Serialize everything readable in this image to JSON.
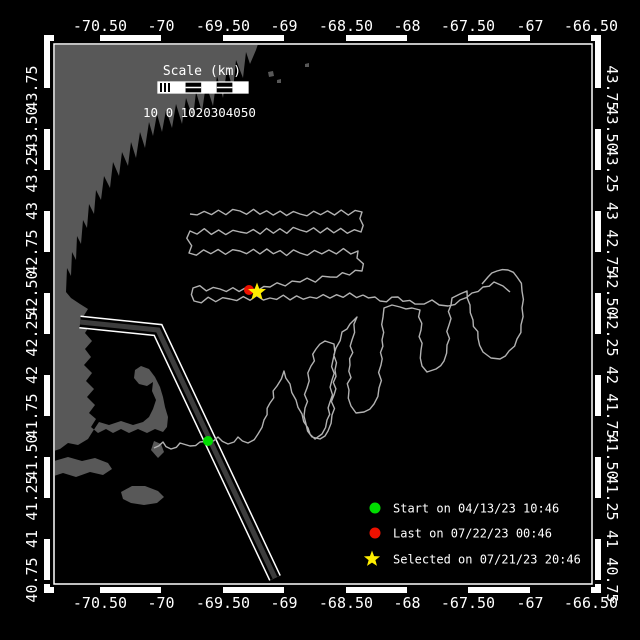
{
  "figure": {
    "kind": "vehicle-track-map",
    "background": "#000000",
    "frame_color": "#ffffff"
  },
  "axes": {
    "lon_labels": [
      "-70.50",
      "-70",
      "-69.50",
      "-69",
      "-68.50",
      "-68",
      "-67.50",
      "-67",
      "-66.50"
    ],
    "lat_labels": [
      "43.75",
      "43.50",
      "43.25",
      "43",
      "42.75",
      "42.50",
      "42.25",
      "42",
      "41.75",
      "41.50",
      "41.25",
      "41",
      "40.75"
    ],
    "lon_range": [
      -70.81,
      -66.5
    ],
    "lat_range": [
      40.72,
      43.97
    ]
  },
  "scalebar": {
    "title": "Scale (km)",
    "labels": "10 0 1020304050"
  },
  "legend": {
    "items": [
      {
        "marker": "circle",
        "color": "#00dd00",
        "label": "Start on 04/13/23 10:46"
      },
      {
        "marker": "circle",
        "color": "#ee1100",
        "label": "Last on 07/22/23 00:46"
      },
      {
        "marker": "star",
        "color": "#ffee00",
        "label": "Selected on 07/21/23 20:46"
      }
    ]
  },
  "map": {
    "land_color": "#585858",
    "track_color": "#b2b2b2",
    "lane_fill": "#3c3c3c",
    "lane_edge": "#ffffff",
    "markers": [
      {
        "name": "start-marker",
        "type": "circle",
        "color": "#00dd00",
        "x": 208,
        "y": 441,
        "r": 5
      },
      {
        "name": "last-marker",
        "type": "circle",
        "color": "#ee1100",
        "x": 249,
        "y": 290,
        "r": 5
      },
      {
        "name": "selected-marker",
        "type": "star",
        "color": "#ffee00",
        "x": 257,
        "y": 292,
        "r": 9.5
      }
    ],
    "lane": [
      [
        80,
        322
      ],
      [
        158,
        330
      ],
      [
        275,
        578
      ]
    ],
    "tracks": [
      {
        "name": "survey-lawnmower",
        "amp": 2.4,
        "pts": [
          [
            190,
            214
          ],
          [
            240,
            211
          ],
          [
            300,
            214
          ],
          [
            362,
            212
          ],
          [
            361,
            232
          ],
          [
            300,
            230
          ],
          [
            240,
            232
          ],
          [
            190,
            231
          ],
          [
            189,
            253
          ],
          [
            240,
            251
          ],
          [
            300,
            253
          ],
          [
            358,
            251
          ],
          [
            362,
            271
          ],
          [
            330,
            277
          ],
          [
            300,
            282
          ],
          [
            270,
            287
          ],
          [
            252,
            290
          ],
          [
            220,
            289
          ],
          [
            193,
            288
          ],
          [
            194,
            301
          ],
          [
            230,
            299
          ],
          [
            270,
            298
          ],
          [
            310,
            297
          ],
          [
            363,
            295
          ]
        ]
      },
      {
        "name": "transit-east",
        "amp": 1.8,
        "pts": [
          [
            363,
            295
          ],
          [
            380,
            301
          ],
          [
            398,
            297
          ],
          [
            415,
            304
          ],
          [
            432,
            300
          ],
          [
            448,
            306
          ],
          [
            460,
            300
          ],
          [
            472,
            293
          ],
          [
            483,
            287
          ],
          [
            494,
            282
          ],
          [
            503,
            286
          ],
          [
            510,
            292
          ]
        ]
      },
      {
        "name": "trail-and-comb",
        "amp": 1.6,
        "pts": [
          [
            154,
            448
          ],
          [
            163,
            442
          ],
          [
            171,
            449
          ],
          [
            180,
            443
          ],
          [
            190,
            446
          ],
          [
            200,
            442
          ],
          [
            208,
            441
          ],
          [
            218,
            437
          ],
          [
            228,
            444
          ],
          [
            238,
            437
          ],
          [
            248,
            443
          ],
          [
            258,
            434
          ],
          [
            264,
            420
          ],
          [
            270,
            403
          ],
          [
            277,
            386
          ],
          [
            284,
            371
          ],
          [
            290,
            384
          ],
          [
            296,
            400
          ],
          [
            302,
            414
          ],
          [
            308,
            428
          ],
          [
            315,
            439
          ],
          [
            322,
            434
          ],
          [
            327,
            420
          ],
          [
            330,
            402
          ],
          [
            332,
            380
          ],
          [
            333,
            360
          ],
          [
            334,
            344
          ],
          [
            325,
            341
          ],
          [
            316,
            349
          ],
          [
            311,
            366
          ],
          [
            307,
            388
          ],
          [
            305,
            408
          ],
          [
            306,
            424
          ],
          [
            312,
            437
          ],
          [
            320,
            439
          ],
          [
            328,
            431
          ],
          [
            332,
            415
          ],
          [
            334,
            395
          ],
          [
            335,
            370
          ],
          [
            336,
            348
          ],
          [
            342,
            332
          ],
          [
            350,
            324
          ],
          [
            357,
            317
          ],
          [
            352,
            340
          ],
          [
            350,
            365
          ],
          [
            349,
            390
          ],
          [
            351,
            406
          ],
          [
            356,
            413
          ],
          [
            364,
            412
          ],
          [
            374,
            404
          ],
          [
            379,
            388
          ],
          [
            381,
            365
          ],
          [
            382,
            340
          ],
          [
            383,
            317
          ],
          [
            384,
            308
          ],
          [
            392,
            305
          ],
          [
            400,
            307
          ],
          [
            412,
            308
          ],
          [
            420,
            310
          ],
          [
            421,
            330
          ],
          [
            421,
            350
          ],
          [
            422,
            366
          ],
          [
            427,
            372
          ],
          [
            436,
            369
          ],
          [
            444,
            361
          ],
          [
            447,
            345
          ],
          [
            449,
            325
          ],
          [
            451,
            305
          ],
          [
            452,
            298
          ],
          [
            460,
            294
          ],
          [
            467,
            291
          ],
          [
            470,
            305
          ],
          [
            473,
            320
          ],
          [
            478,
            338
          ],
          [
            483,
            352
          ],
          [
            491,
            358
          ],
          [
            500,
            359
          ],
          [
            509,
            351
          ],
          [
            517,
            339
          ],
          [
            521,
            325
          ],
          [
            522,
            308
          ],
          [
            522,
            291
          ],
          [
            517,
            277
          ],
          [
            508,
            270
          ],
          [
            497,
            271
          ],
          [
            488,
            277
          ],
          [
            482,
            284
          ]
        ]
      }
    ],
    "land": [
      [
        [
          54,
          44
        ],
        [
          258,
          44
        ],
        [
          256,
          50
        ],
        [
          250,
          64
        ],
        [
          246,
          52
        ],
        [
          243,
          78
        ],
        [
          236,
          60
        ],
        [
          233,
          90
        ],
        [
          227,
          68
        ],
        [
          223,
          98
        ],
        [
          217,
          76
        ],
        [
          213,
          106
        ],
        [
          206,
          84
        ],
        [
          202,
          112
        ],
        [
          196,
          92
        ],
        [
          193,
          118
        ],
        [
          186,
          98
        ],
        [
          182,
          124
        ],
        [
          176,
          104
        ],
        [
          172,
          128
        ],
        [
          166,
          110
        ],
        [
          162,
          132
        ],
        [
          157,
          114
        ],
        [
          153,
          136
        ],
        [
          149,
          122
        ],
        [
          145,
          148
        ],
        [
          140,
          132
        ],
        [
          136,
          158
        ],
        [
          131,
          142
        ],
        [
          128,
          166
        ],
        [
          122,
          152
        ],
        [
          119,
          176
        ],
        [
          113,
          162
        ],
        [
          110,
          188
        ],
        [
          104,
          176
        ],
        [
          101,
          200
        ],
        [
          96,
          190
        ],
        [
          94,
          214
        ],
        [
          89,
          204
        ],
        [
          87,
          228
        ],
        [
          83,
          220
        ],
        [
          81,
          244
        ],
        [
          77,
          236
        ],
        [
          76,
          260
        ],
        [
          72,
          252
        ],
        [
          71,
          276
        ],
        [
          67,
          268
        ],
        [
          66,
          292
        ],
        [
          71,
          298
        ],
        [
          80,
          304
        ],
        [
          88,
          309
        ],
        [
          83,
          317
        ],
        [
          90,
          325
        ],
        [
          85,
          333
        ],
        [
          92,
          341
        ],
        [
          85,
          349
        ],
        [
          91,
          357
        ],
        [
          84,
          365
        ],
        [
          92,
          373
        ],
        [
          86,
          381
        ],
        [
          94,
          389
        ],
        [
          87,
          397
        ],
        [
          95,
          405
        ],
        [
          89,
          413
        ],
        [
          96,
          419
        ],
        [
          91,
          427
        ],
        [
          98,
          433
        ],
        [
          106,
          429
        ],
        [
          113,
          433
        ],
        [
          121,
          429
        ],
        [
          129,
          433
        ],
        [
          138,
          429
        ],
        [
          147,
          433
        ],
        [
          155,
          429
        ],
        [
          163,
          432
        ],
        [
          167,
          427
        ],
        [
          168,
          417
        ],
        [
          165,
          407
        ],
        [
          163,
          397
        ],
        [
          160,
          387
        ],
        [
          155,
          377
        ],
        [
          149,
          369
        ],
        [
          141,
          366
        ],
        [
          135,
          370
        ],
        [
          134,
          378
        ],
        [
          139,
          384
        ],
        [
          147,
          386
        ],
        [
          153,
          382
        ],
        [
          152,
          391
        ],
        [
          156,
          400
        ],
        [
          153,
          409
        ],
        [
          149,
          417
        ],
        [
          143,
          422
        ],
        [
          133,
          425
        ],
        [
          121,
          421
        ],
        [
          109,
          425
        ],
        [
          99,
          422
        ],
        [
          93,
          431
        ],
        [
          88,
          439
        ],
        [
          78,
          445
        ],
        [
          68,
          443
        ],
        [
          60,
          449
        ],
        [
          54,
          451
        ]
      ],
      [
        [
          54,
          461
        ],
        [
          68,
          457
        ],
        [
          82,
          461
        ],
        [
          95,
          458
        ],
        [
          108,
          463
        ],
        [
          112,
          469
        ],
        [
          103,
          475
        ],
        [
          90,
          472
        ],
        [
          76,
          477
        ],
        [
          63,
          473
        ],
        [
          54,
          476
        ]
      ],
      [
        [
          121,
          492
        ],
        [
          132,
          486
        ],
        [
          145,
          486
        ],
        [
          158,
          491
        ],
        [
          164,
          497
        ],
        [
          157,
          503
        ],
        [
          144,
          505
        ],
        [
          131,
          503
        ],
        [
          123,
          499
        ]
      ],
      [
        [
          154,
          441
        ],
        [
          161,
          444
        ],
        [
          164,
          452
        ],
        [
          158,
          458
        ],
        [
          151,
          450
        ]
      ],
      [
        [
          268,
          72
        ],
        [
          273,
          71
        ],
        [
          274,
          76
        ],
        [
          269,
          77
        ]
      ],
      [
        [
          277,
          80
        ],
        [
          281,
          79
        ],
        [
          281,
          83
        ],
        [
          277,
          83
        ]
      ],
      [
        [
          305,
          64
        ],
        [
          309,
          63
        ],
        [
          309,
          67
        ],
        [
          305,
          67
        ]
      ]
    ]
  }
}
